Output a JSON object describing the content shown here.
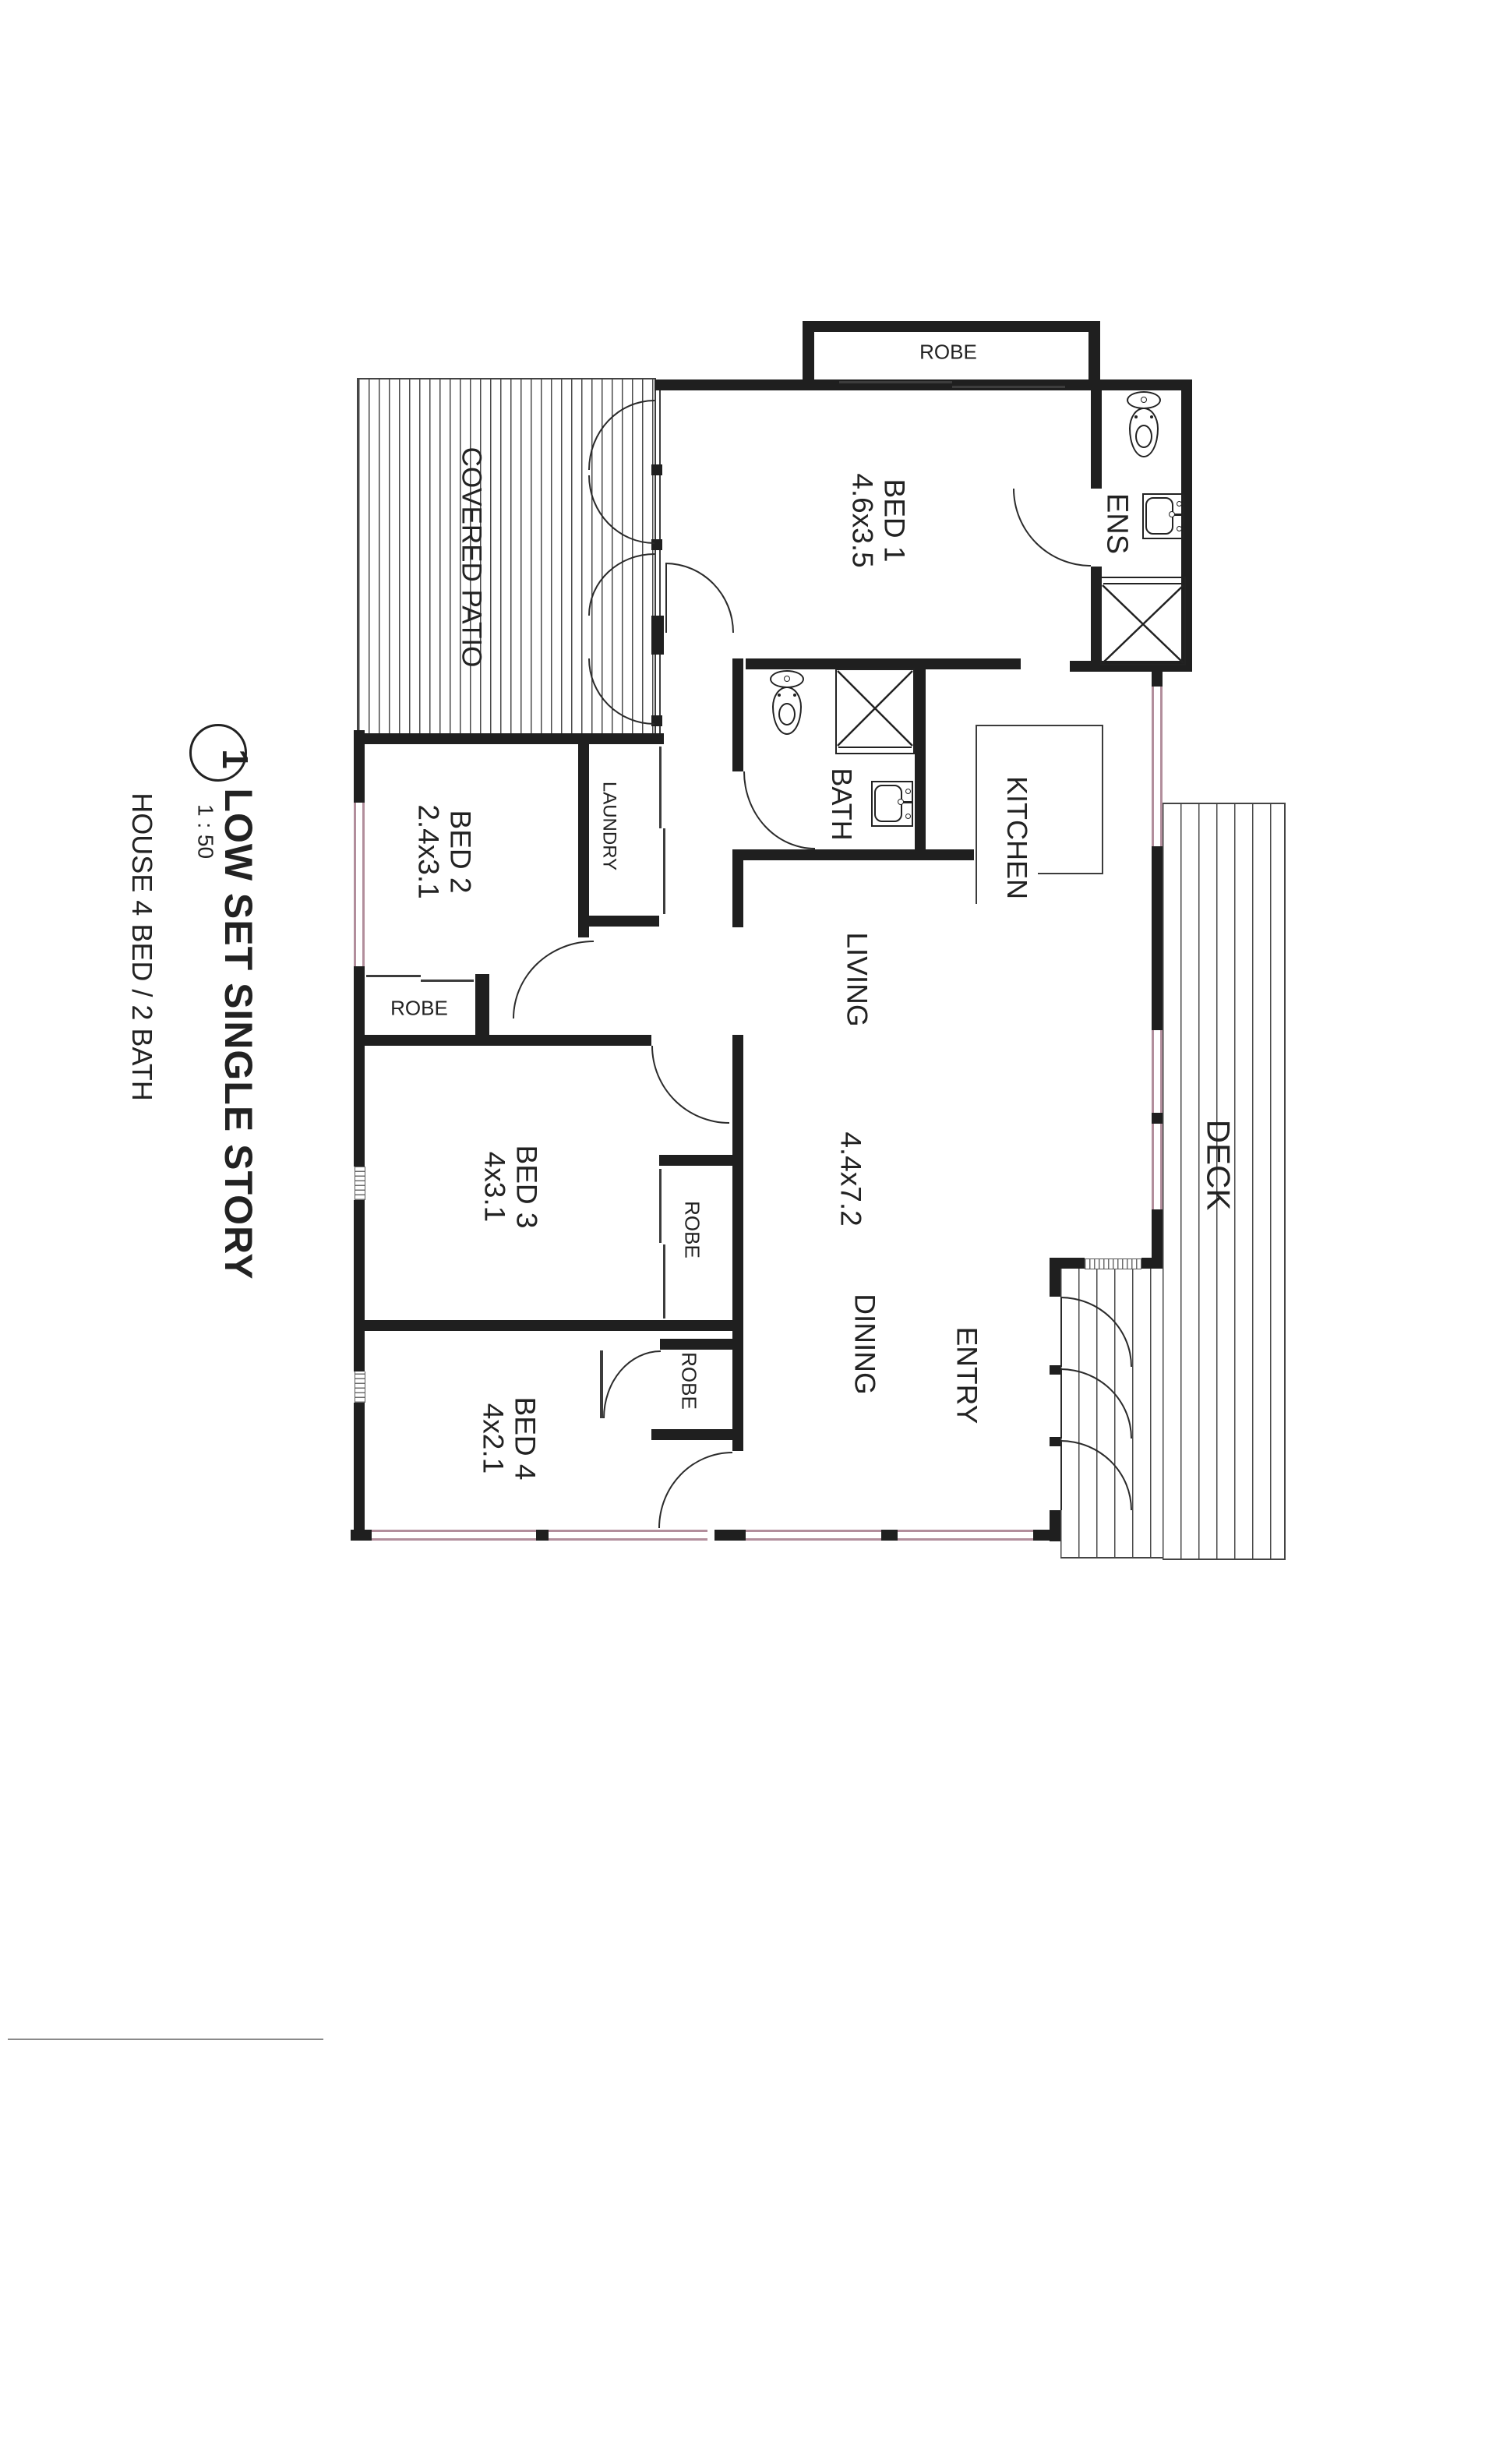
{
  "title_block": {
    "sheet_number": "1",
    "title": "LOW SET SINGLE STORY",
    "scale": "1 : 50",
    "subtitle": "HOUSE 4 BED / 2 BATH"
  },
  "rooms": {
    "covered_patio": {
      "label": "COVERED PATIO"
    },
    "deck": {
      "label": "DECK"
    },
    "bed1": {
      "label": "BED 1",
      "dims": "4.6x3.5"
    },
    "bed2": {
      "label": "BED 2",
      "dims": "2.4x3.1"
    },
    "bed3": {
      "label": "BED 3",
      "dims": "4x3.1"
    },
    "bed4": {
      "label": "BED 4",
      "dims": "4x2.1"
    },
    "living": {
      "label": "LIVING",
      "dims": "4.4x7.2"
    },
    "dining": {
      "label": "DINING"
    },
    "entry": {
      "label": "ENTRY"
    },
    "kitchen": {
      "label": "KITCHEN"
    },
    "bath": {
      "label": "BATH"
    },
    "ens": {
      "label": "ENS"
    },
    "laundry": {
      "label": "LAUNDRY"
    },
    "robe_bed1": {
      "label": "ROBE"
    },
    "robe_bed2": {
      "label": "ROBE"
    },
    "robe_bed3": {
      "label": "ROBE"
    },
    "robe_bed4": {
      "label": "ROBE"
    }
  },
  "colors": {
    "wall": "#1f1f1f",
    "window": "#b28e9c",
    "hatch_line": "#4a4a4a",
    "text": "#222222"
  }
}
